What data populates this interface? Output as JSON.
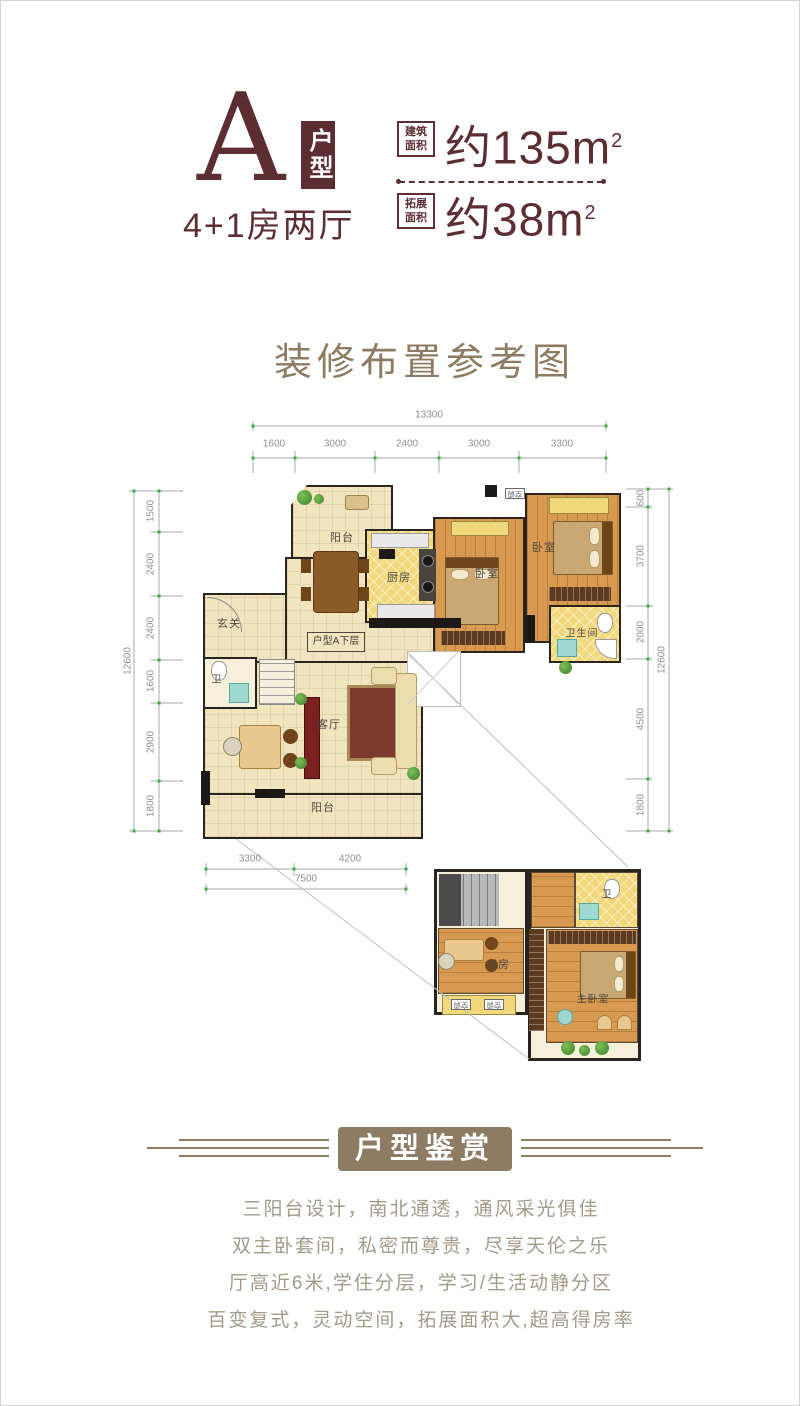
{
  "header": {
    "type_letter": "A",
    "type_badge": "户型",
    "layout_text": "4+1房两厅",
    "metrics": [
      {
        "label_line1": "建筑",
        "label_line2": "面积",
        "value": "约135m",
        "sup": "2"
      },
      {
        "label_line1": "拓展",
        "label_line2": "面积",
        "value": "约38m",
        "sup": "2"
      }
    ]
  },
  "section_title": "装修布置参考图",
  "floorplan": {
    "dims_top": {
      "total": "13300",
      "segments": [
        "1600",
        "3000",
        "2400",
        "3000",
        "3300"
      ]
    },
    "dims_left": {
      "total": "12600",
      "segments": [
        "1500",
        "2400",
        "2400",
        "1600",
        "2900",
        "1800"
      ]
    },
    "dims_right": {
      "total": "12600",
      "segments": [
        "600",
        "3700",
        "2000",
        "4500",
        "1800"
      ]
    },
    "dims_bottom": {
      "total": "7500",
      "segments": [
        "3300",
        "4200"
      ]
    },
    "labels": {
      "balcony_top": "阳台",
      "kitchen": "厨房",
      "bedroom1": "卧室",
      "bedroom2": "卧室",
      "bathroom": "卫生间",
      "entry": "玄关",
      "toilet": "卫",
      "living": "客厅",
      "balcony_bottom": "阳台",
      "floor_tag": "户型A下层",
      "ac": "空调"
    },
    "upper": {
      "study": "书房",
      "master_bedroom": "主卧室",
      "toilet": "卫",
      "ac": "空调"
    }
  },
  "banner": {
    "text": "户型鉴赏"
  },
  "features": [
    "三阳台设计，南北通透，通风采光俱佳",
    "双主卧套间，私密而尊贵，尽享天伦之乐",
    "厅高近6米,学住分层，学习/生活动静分区",
    "百变复式，灵动空间，拓展面积大,超高得房率"
  ],
  "colors": {
    "maroon": "#5c2e32",
    "brown": "#8d7b63",
    "feature_text": "#a39a8a",
    "tick_green": "#3fae3f",
    "cream_floor": "#f0e5bf",
    "tile_yellow": "#f2d87c",
    "wood_floor": "#d79a50"
  }
}
